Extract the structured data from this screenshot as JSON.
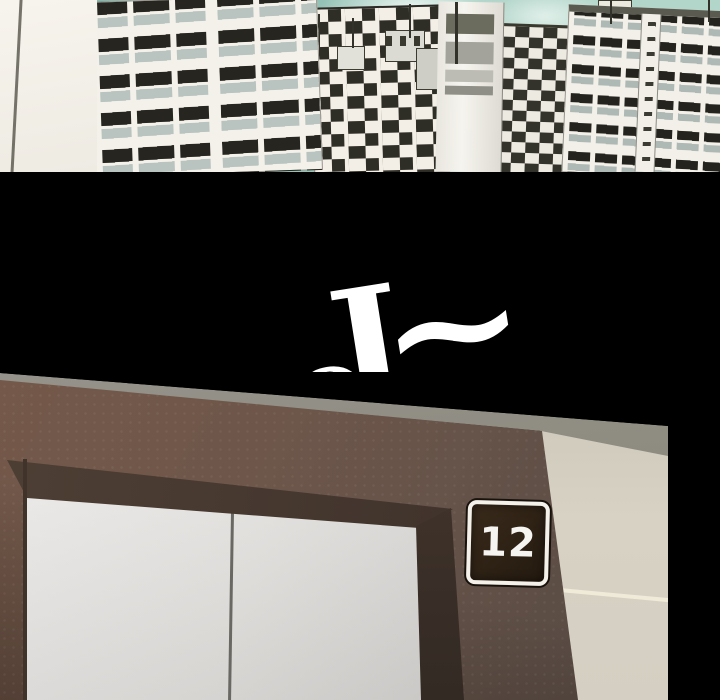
{
  "comic": {
    "sfx": {
      "text": "OJ~",
      "char_o": "O",
      "char_j": "J",
      "char_tilde": "~"
    },
    "elevator": {
      "floor_sign": "12"
    },
    "colors": {
      "sky_teal": "#96c3b7",
      "building_offwhite": "#f4f1ea",
      "window_dark": "#26251f",
      "window_glass": "#b9c4c0",
      "gutter_black": "#000000",
      "sfx_white": "#ffffff",
      "wall_brown": "#6e564a",
      "wall_upper_gray": "#8b8a7f",
      "wall_beige": "#d5cfc3",
      "door_light": "#e6e4e1",
      "reveal_dark": "#3f332b",
      "sign_bg": "#2b2015",
      "sign_border": "#f3f1ea",
      "sign_text": "#ffffff"
    }
  }
}
